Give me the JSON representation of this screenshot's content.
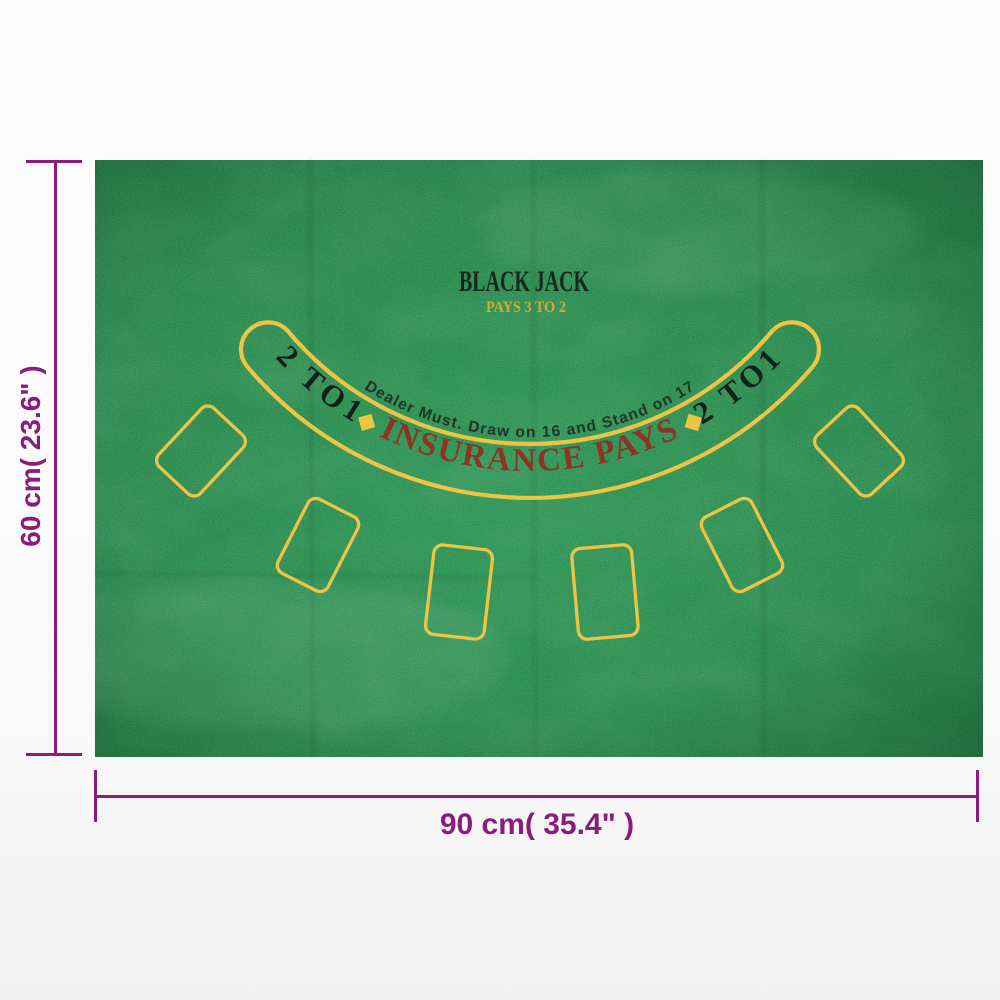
{
  "mat": {
    "title": "BLACK JACK",
    "subtitle": "PAYS 3 TO 2",
    "dealer_rule": "Dealer Must. Draw on 16 and Stand on 17",
    "insurance_label": "INSURANCE PAYS",
    "odds_left": "2 TO1",
    "odds_right": "2 TO1",
    "diamond_glyph": "◆",
    "card_spots": [
      {
        "cx": 201,
        "cy": 451,
        "rot": 43,
        "w": 57,
        "h": 80
      },
      {
        "cx": 318,
        "cy": 545,
        "rot": 27,
        "w": 56,
        "h": 83
      },
      {
        "cx": 459,
        "cy": 592,
        "rot": 6.5,
        "w": 59,
        "h": 90
      },
      {
        "cx": 605,
        "cy": 592,
        "rot": -5,
        "w": 60,
        "h": 91
      },
      {
        "cx": 742,
        "cy": 545,
        "rot": -27,
        "w": 56,
        "h": 83
      },
      {
        "cx": 859,
        "cy": 451,
        "rot": -43,
        "w": 57,
        "h": 80
      }
    ]
  },
  "dimensions": {
    "height_label": "60 cm( 23.6\" )",
    "width_label": "90 cm( 35.4\" )"
  },
  "colors": {
    "background": "#fbfbfb",
    "felt_green": "#27914e",
    "line_yellow": "#eec445",
    "gold_text": "#d9a930",
    "ink_text": "#18271d",
    "insurance_red": "#8e3424",
    "dimension_purple": "#8a1c7c"
  }
}
